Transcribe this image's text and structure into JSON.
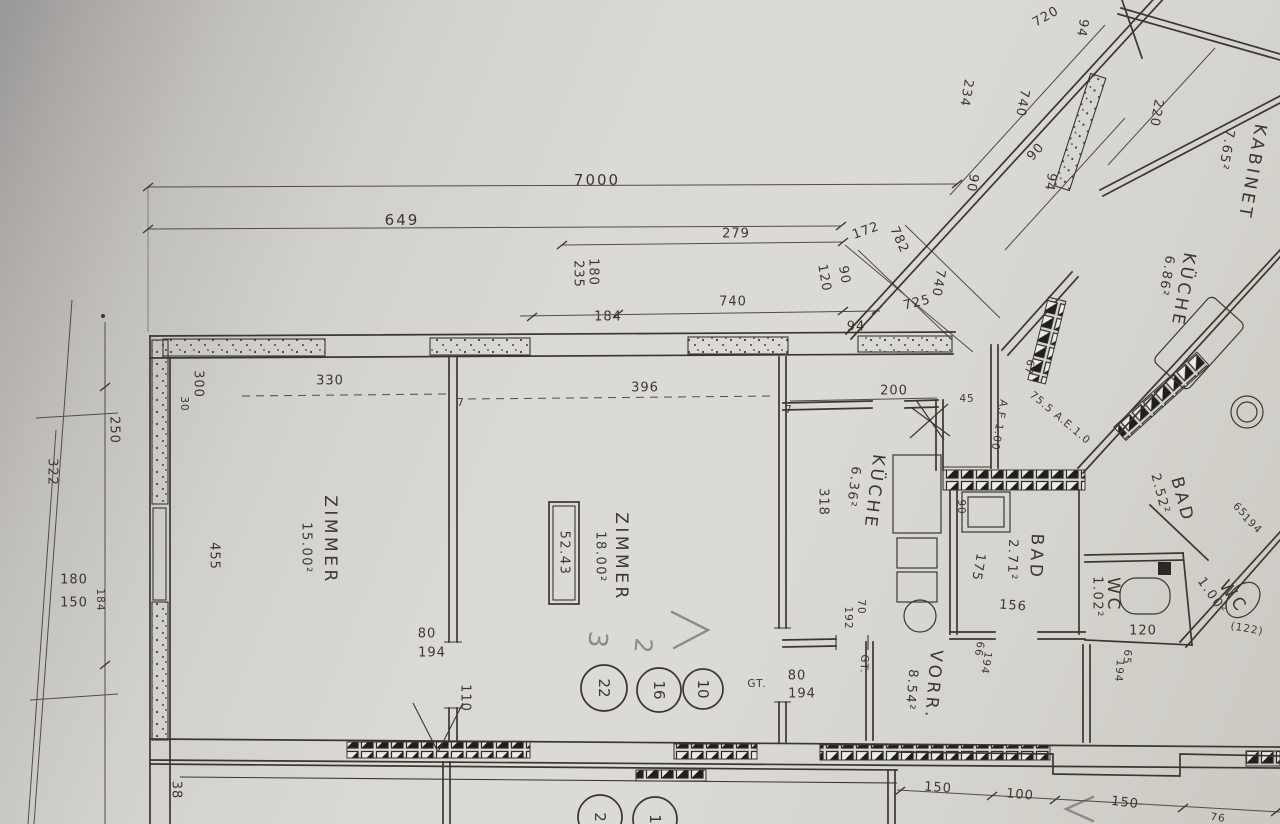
{
  "rooms": [
    {
      "label": "ZIMMER",
      "area": "15.00²"
    },
    {
      "label": "ZIMMER",
      "area": "18.00²"
    },
    {
      "label": "KÜCHE",
      "area": "6.36²"
    },
    {
      "label": "BAD",
      "area": "2.71²"
    },
    {
      "label": "VORR.",
      "area": "8.54²"
    },
    {
      "label": "WC",
      "area": "1.02²"
    },
    {
      "label": "KABINET",
      "area": "7.65²"
    },
    {
      "label": "KÜCHE",
      "area": "6.86²"
    },
    {
      "label": "BAD",
      "area": "2.52²"
    },
    {
      "label": "WC",
      "area": "1.00²"
    }
  ],
  "summary": {
    "boxed_value": "52.43"
  },
  "circled": {
    "upper": [
      "22",
      "16",
      "10"
    ],
    "lower": [
      "2",
      "1"
    ]
  },
  "annotations": {
    "gt": "GT.",
    "ae": "A.E.1.00",
    "ae_route": "75.5 A.E.1.0",
    "pencil_3": "3",
    "pencil_2": "2"
  },
  "dims": {
    "7000": "7000",
    "649": "649",
    "279": "279",
    "180": "180",
    "235": "235",
    "184": "184",
    "740": "740",
    "94": "94",
    "90": "90",
    "172": "172",
    "782": "782",
    "120": "120",
    "725": "725",
    "234": "234",
    "720": "720",
    "220": "220",
    "330": "330",
    "396": "396",
    "200": "200",
    "300": "300",
    "30": "30",
    "322": "322",
    "250": "250",
    "150": "150",
    "455": "455",
    "110": "110",
    "80": "80",
    "194": "194",
    "318": "318",
    "70": "70",
    "192": "192",
    "66": "66",
    "156": "156",
    "175": "175",
    "65": "65",
    "122": "(122)",
    "100": "100",
    "76": "76",
    "38": "38",
    "45": "45",
    "67": "67",
    "7": "7"
  }
}
